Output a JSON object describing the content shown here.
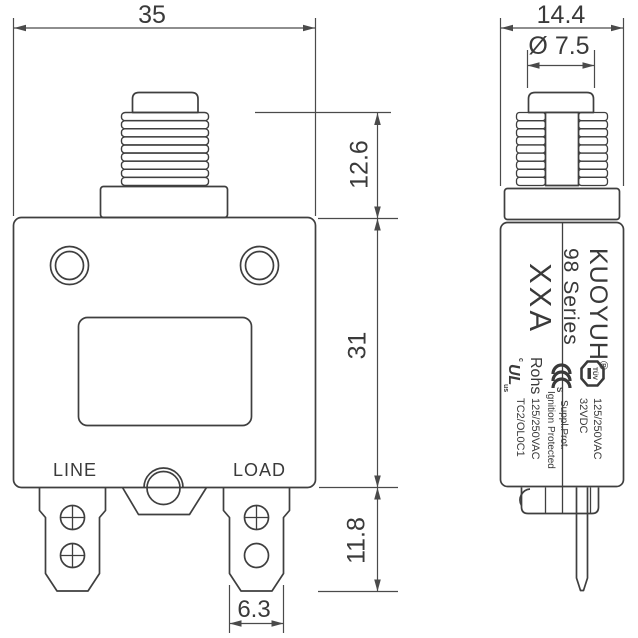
{
  "front_view": {
    "dims": {
      "width": "35",
      "bushing_height": "12.6",
      "body_height": "31",
      "terminal_height": "11.8",
      "terminal_width": "6.3"
    },
    "terminal_labels": {
      "line": "LINE",
      "load": "LOAD"
    }
  },
  "side_view": {
    "dims": {
      "depth": "14.4",
      "button_diameter": "Ø 7.5"
    },
    "label": {
      "brand": "KUOYUH",
      "reg_mark": "®",
      "series": "98 Series",
      "model": "XXA",
      "cert_tuv": "TÜV",
      "rating_primary_l1": "125/250VAC",
      "rating_primary_l2": "32VDC",
      "cert_ccc_s": "S",
      "suppl_prot": "Suppl.Prot.",
      "ignition": "Ignition Protected",
      "rohs": "Rohs",
      "rating_secondary": "125/250VAC",
      "ul_c": "c",
      "ul": "UL",
      "ul_us": "us",
      "code": "TC2/OL0C1"
    }
  },
  "colors": {
    "line": "#3f3f3f",
    "dim": "#4a4a4a",
    "background": "#ffffff"
  }
}
